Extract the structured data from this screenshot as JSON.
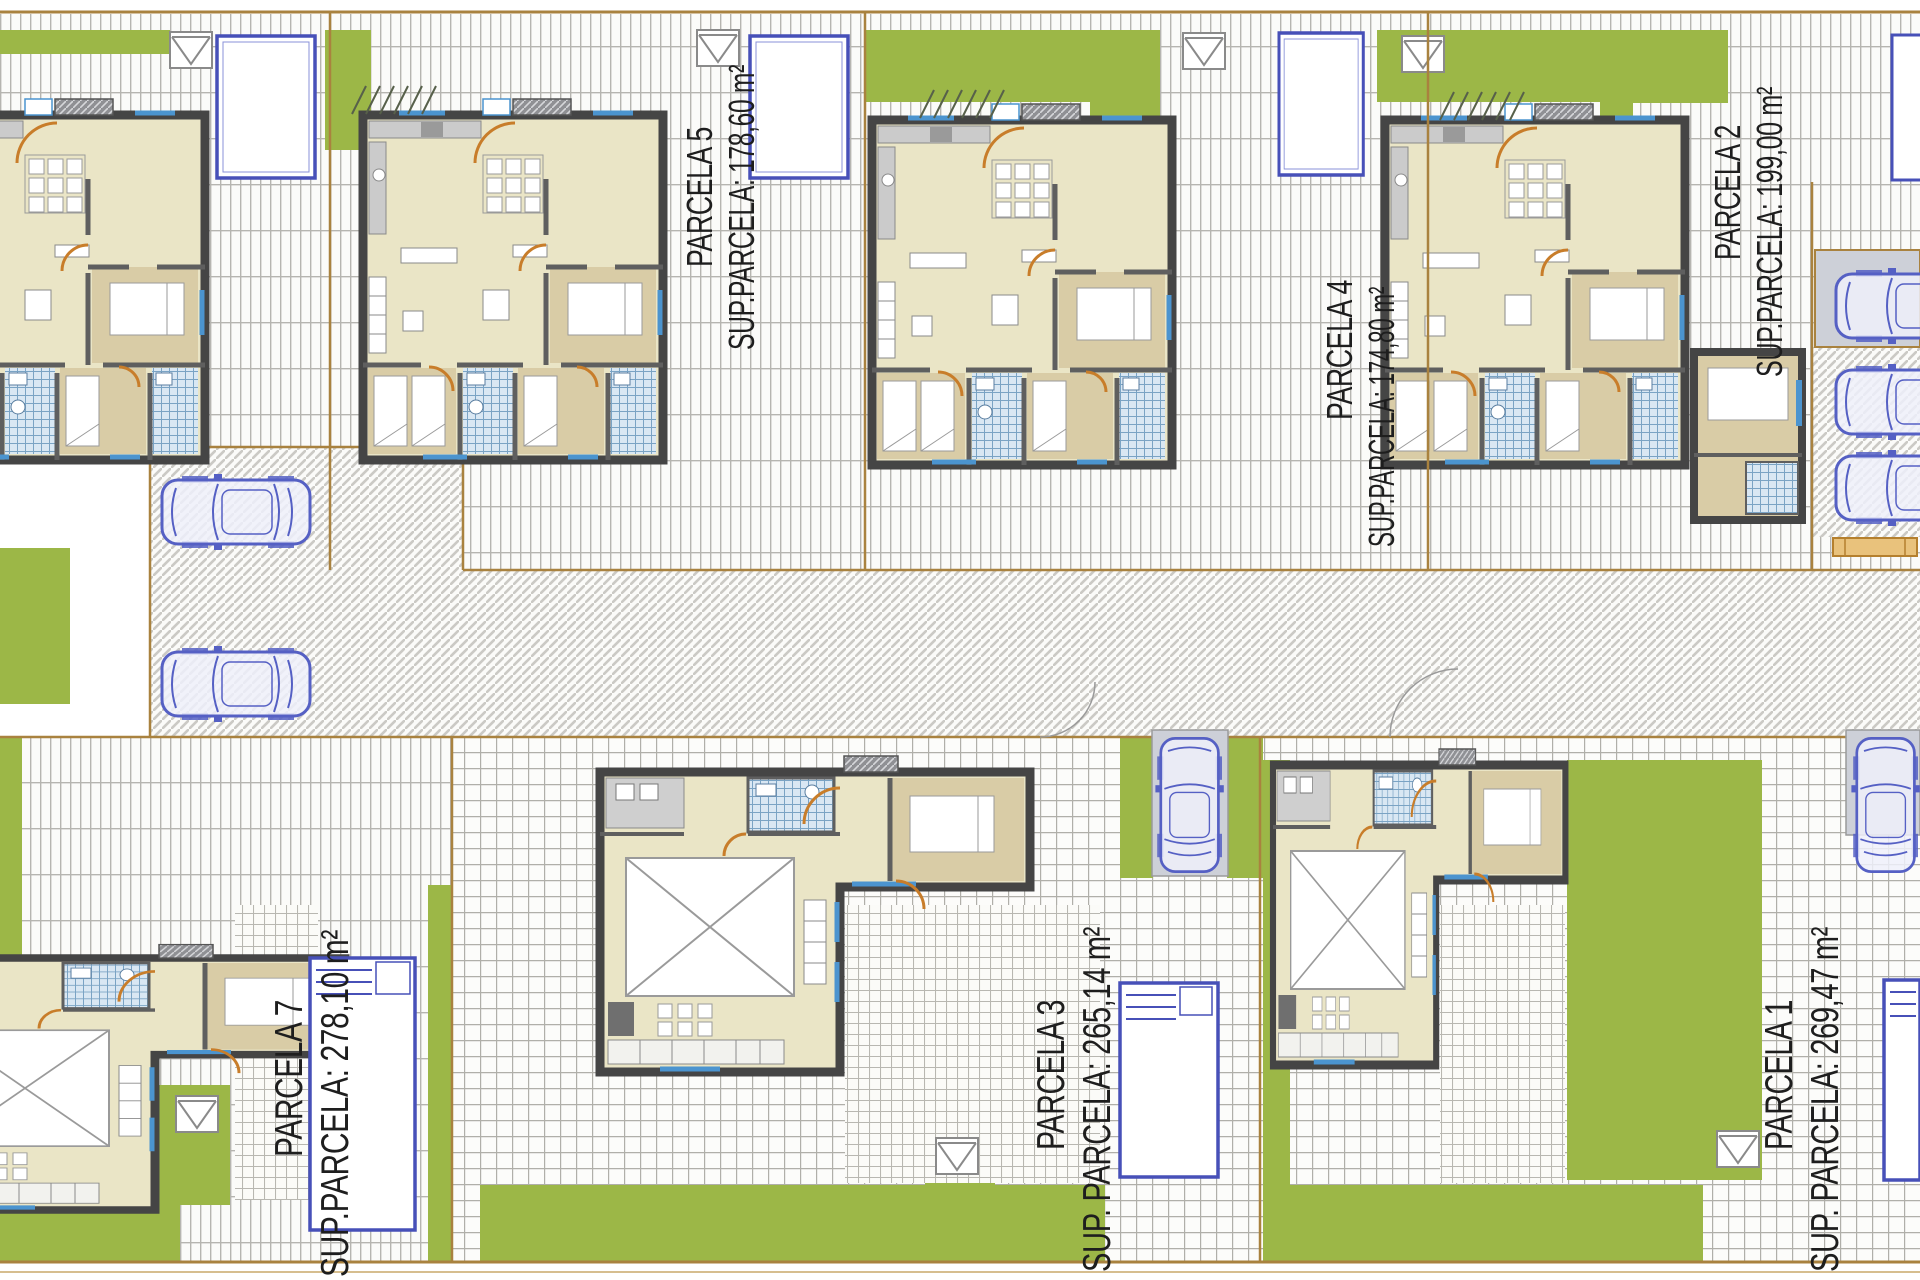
{
  "parcels": [
    {
      "id": "parcela-5",
      "name": "PARCELA 5",
      "area_label": "SUP.PARCELA: 178,60 m²"
    },
    {
      "id": "parcela-4",
      "name": "PARCELA 4",
      "area_label": "SUP.PARCELA: 174,80 m²"
    },
    {
      "id": "parcela-2",
      "name": "PARCELA 2",
      "area_label": "SUP.PARCELA: 199,00 m²"
    },
    {
      "id": "parcela-7",
      "name": "PARCELA 7",
      "area_label": "SUP.PARCELA: 278,10 m²"
    },
    {
      "id": "parcela-3",
      "name": "PARCELA 3",
      "area_label": "SUP. PARCELA: 265,14 m²"
    },
    {
      "id": "parcela-1",
      "name": "PARCELA 1",
      "area_label": "SUP. PARCELA: 269,47 m²"
    }
  ],
  "icons": {
    "roof": "gable-roof-icon",
    "car": "car-top-view-icon",
    "pool": "swimming-pool-icon"
  },
  "colors": {
    "green": "#9cb747",
    "interior_beige": "#eae5c6",
    "bedroom_tan": "#d9cca6",
    "wall_dark": "#454545",
    "pool_blue": "#4750b8",
    "car_blue": "#5560c4",
    "boundary_brown": "#a9823f",
    "bath_tile_blue": "#7aa3c4",
    "label_text": "#1e1e1e"
  }
}
